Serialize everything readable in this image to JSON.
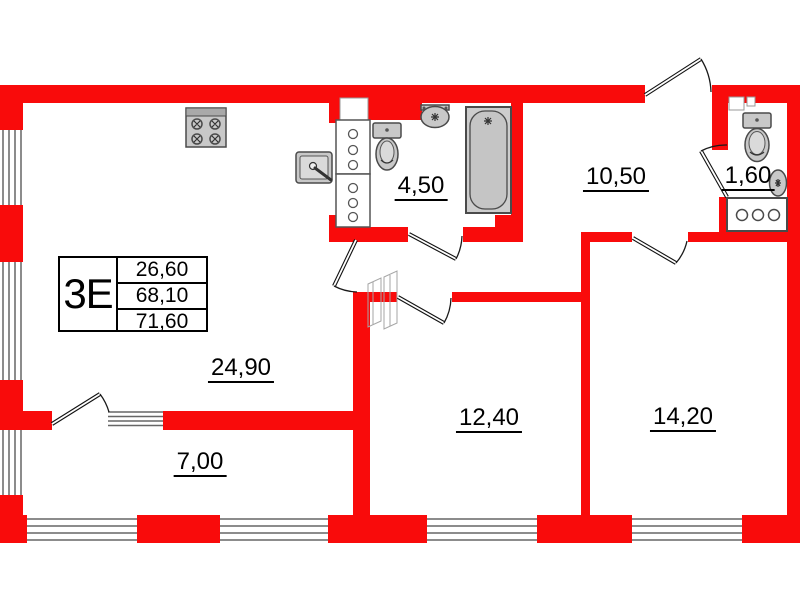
{
  "title": "apartment-floor-plan",
  "colors": {
    "wall_red": "#f90b0b",
    "fixture_fill": "#c8c8c8",
    "fixture_stroke": "#4a4a4a",
    "window_line": "#666666",
    "text": "#000000"
  },
  "stamp": {
    "type_label": "3Е",
    "values": [
      "26,60",
      "68,10",
      "71,60"
    ]
  },
  "rooms": [
    {
      "name": "kitchen-living-room",
      "area": "24,90"
    },
    {
      "name": "room-7",
      "area": "7,00"
    },
    {
      "name": "room-12",
      "area": "12,40"
    },
    {
      "name": "room-14",
      "area": "14,20"
    },
    {
      "name": "bathroom",
      "area": "4,50"
    },
    {
      "name": "hallway",
      "area": "10,50"
    },
    {
      "name": "wc",
      "area": "1,60"
    }
  ],
  "fixtures": [
    "stove-icon",
    "kitchen-sink-icon",
    "vent-shaft-icon",
    "toilet-icon",
    "washbasin-icon",
    "bathtub-icon",
    "wc-toilet-icon",
    "wc-washbasin-icon",
    "washing-machine-icon"
  ]
}
